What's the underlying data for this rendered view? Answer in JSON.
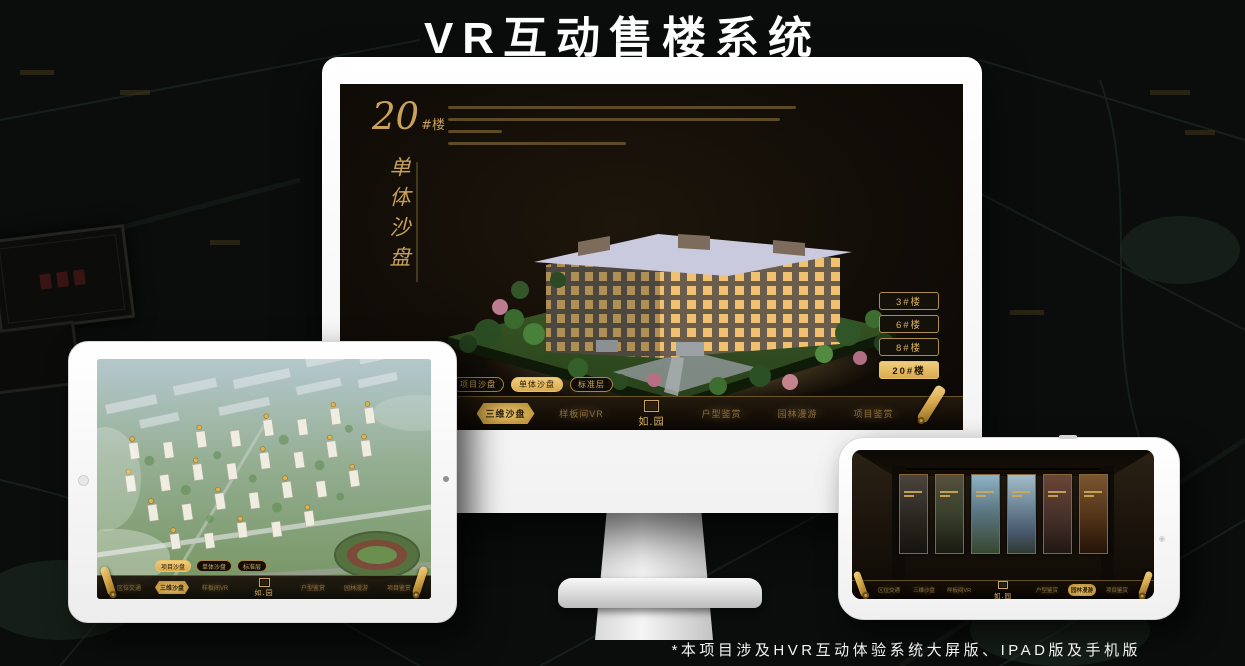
{
  "page": {
    "title": "VR互动售楼系统",
    "footnote": "*本项目涉及HVR互动体验系统大屏版、IPAD版及手机版"
  },
  "colors": {
    "background": "#0a0d0b",
    "gold": "#d8b565",
    "gold_active": "#e8c06a",
    "screen_bg": "#17110a",
    "title_text": "#fdfdfd"
  },
  "nav": {
    "items": [
      {
        "label": "区位交通"
      },
      {
        "label": "三维沙盘"
      },
      {
        "label": "样板间VR"
      },
      {
        "label": "户型鉴赏"
      },
      {
        "label": "园林漫游"
      },
      {
        "label": "项目鉴赏"
      }
    ],
    "logo": "如.园"
  },
  "monitor_app": {
    "heading_number": "20",
    "heading_suffix": "#楼",
    "heading_vertical": "单体沙盘",
    "sub_tabs": [
      {
        "label": "项目沙盘",
        "active": false
      },
      {
        "label": "单体沙盘",
        "active": true
      },
      {
        "label": "标准层",
        "active": false
      }
    ],
    "tower_buttons": [
      {
        "label": "3#楼",
        "active": false
      },
      {
        "label": "6#楼",
        "active": false
      },
      {
        "label": "8#楼",
        "active": false
      },
      {
        "label": "20#楼",
        "active": true
      }
    ]
  },
  "tablet_app": {
    "sub_tabs": [
      {
        "label": "项目沙盘",
        "active": true
      },
      {
        "label": "单体沙盘",
        "active": false
      },
      {
        "label": "标准层",
        "active": false
      }
    ]
  }
}
